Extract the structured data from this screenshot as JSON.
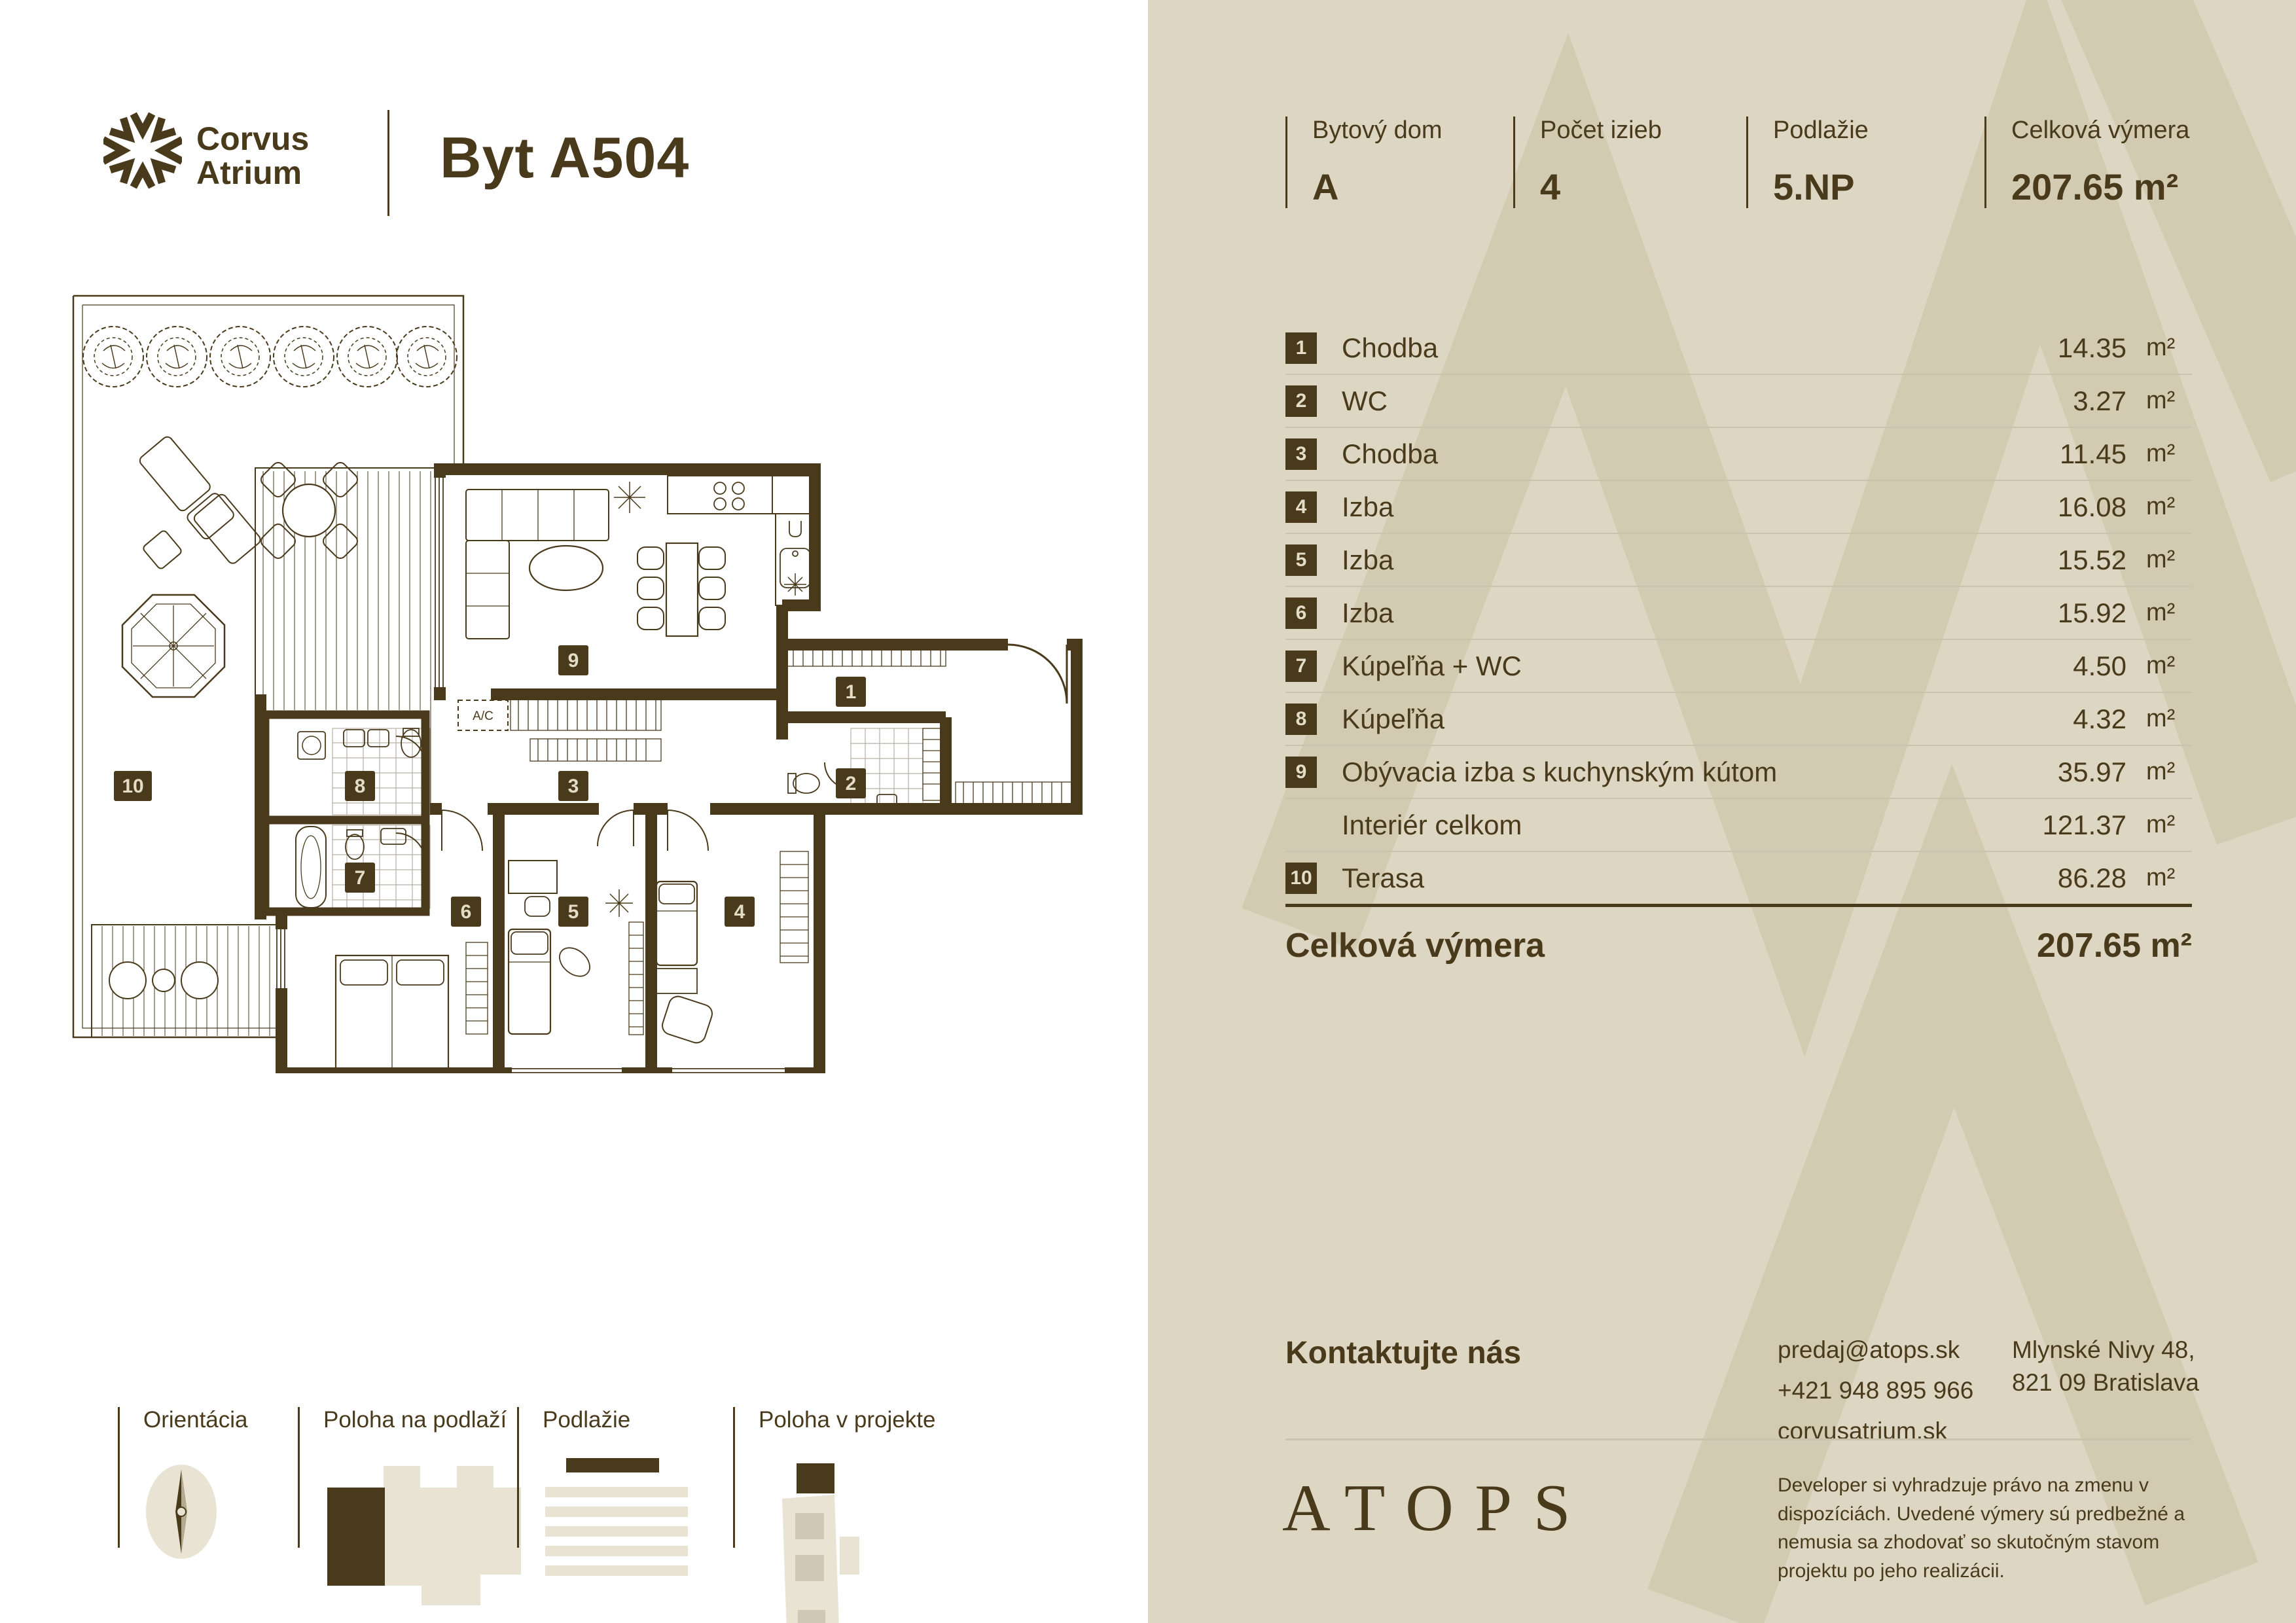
{
  "brand": {
    "name_line1": "Corvus",
    "name_line2": "Atrium",
    "unit_title": "Byt A504"
  },
  "stats": [
    {
      "label": "Bytový dom",
      "value": "A"
    },
    {
      "label": "Počet izieb",
      "value": "4"
    },
    {
      "label": "Podlažie",
      "value": "5.NP"
    },
    {
      "label": "Celková výmera",
      "value": "207.65 m²"
    }
  ],
  "rooms": {
    "rows": [
      {
        "num": "1",
        "name": "Chodba",
        "area": "14.35",
        "unit": "m²"
      },
      {
        "num": "2",
        "name": "WC",
        "area": "3.27",
        "unit": "m²"
      },
      {
        "num": "3",
        "name": "Chodba",
        "area": "11.45",
        "unit": "m²"
      },
      {
        "num": "4",
        "name": "Izba",
        "area": "16.08",
        "unit": "m²"
      },
      {
        "num": "5",
        "name": "Izba",
        "area": "15.52",
        "unit": "m²"
      },
      {
        "num": "6",
        "name": "Izba",
        "area": "15.92",
        "unit": "m²"
      },
      {
        "num": "7",
        "name": "Kúpeľňa + WC",
        "area": "4.50",
        "unit": "m²"
      },
      {
        "num": "8",
        "name": "Kúpeľňa",
        "area": "4.32",
        "unit": "m²"
      },
      {
        "num": "9",
        "name": "Obývacia izba s kuchynským kútom",
        "area": "35.97",
        "unit": "m²"
      },
      {
        "num": "",
        "name": "Interiér celkom",
        "area": "121.37",
        "unit": "m²"
      },
      {
        "num": "10",
        "name": "Terasa",
        "area": "86.28",
        "unit": "m²"
      }
    ],
    "total": {
      "label": "Celková výmera",
      "value": "207.65 m²"
    }
  },
  "contact": {
    "heading": "Kontaktujte nás",
    "email": "predaj@atops.sk",
    "phone": "+421 948 895 966",
    "website": "corvusatrium.sk",
    "address_line1": "Mlynské Nivy 48,",
    "address_line2": "821 09 Bratislava"
  },
  "footer": {
    "brand": "ATOPS",
    "disclaimer": "Developer si vyhradzuje právo na zmenu v dispozíciách. Uvedené výmery sú predbežné a nemusia sa zhodovať so skutočným stavom projektu po jeho realizácii."
  },
  "legend": {
    "items": [
      {
        "label": "Orientácia"
      },
      {
        "label": "Poloha na podlaží"
      },
      {
        "label": "Podlažie"
      },
      {
        "label": "Poloha v projekte"
      }
    ]
  },
  "plan": {
    "ac_label": "A/C",
    "badges": {
      "b1": "1",
      "b2": "2",
      "b3": "3",
      "b4": "4",
      "b5": "5",
      "b6": "6",
      "b7": "7",
      "b8": "8",
      "b9": "9",
      "b10": "10"
    }
  },
  "colors": {
    "accent": "#4a3a1c",
    "panel_bg": "#ddd6c2",
    "watermark": "#d2cab1",
    "separator": "#c9c2ad"
  }
}
